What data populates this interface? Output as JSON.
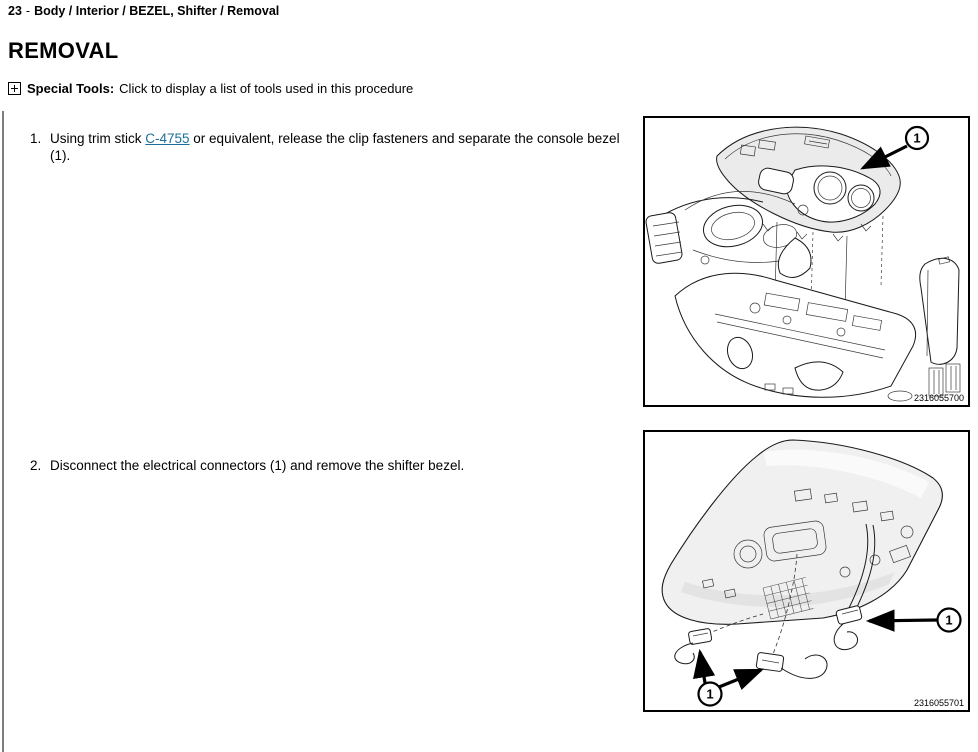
{
  "breadcrumb": {
    "section_number": "23",
    "separator": "-",
    "path": "Body / Interior / BEZEL, Shifter / Removal"
  },
  "title": "REMOVAL",
  "special_tools": {
    "label": "Special Tools:",
    "text": "Click to display a list of tools used in this procedure"
  },
  "steps": [
    {
      "number": "1.",
      "text_before_link": "Using trim stick ",
      "link_text": "C-4755",
      "text_after_link": " or equivalent, release the clip fasteners and separate the console bezel (1)."
    },
    {
      "number": "2.",
      "text": "Disconnect the electrical connectors (1) and remove the shifter bezel."
    }
  ],
  "figures": [
    {
      "figure_number": "2316055700",
      "callout_label": "1"
    },
    {
      "figure_number": "2316055701",
      "callout_label_left": "1",
      "callout_label_right": "1"
    }
  ],
  "colors": {
    "link": "#1c6f9c",
    "figure_border": "#000000",
    "left_rule": "#7d7d7d"
  }
}
